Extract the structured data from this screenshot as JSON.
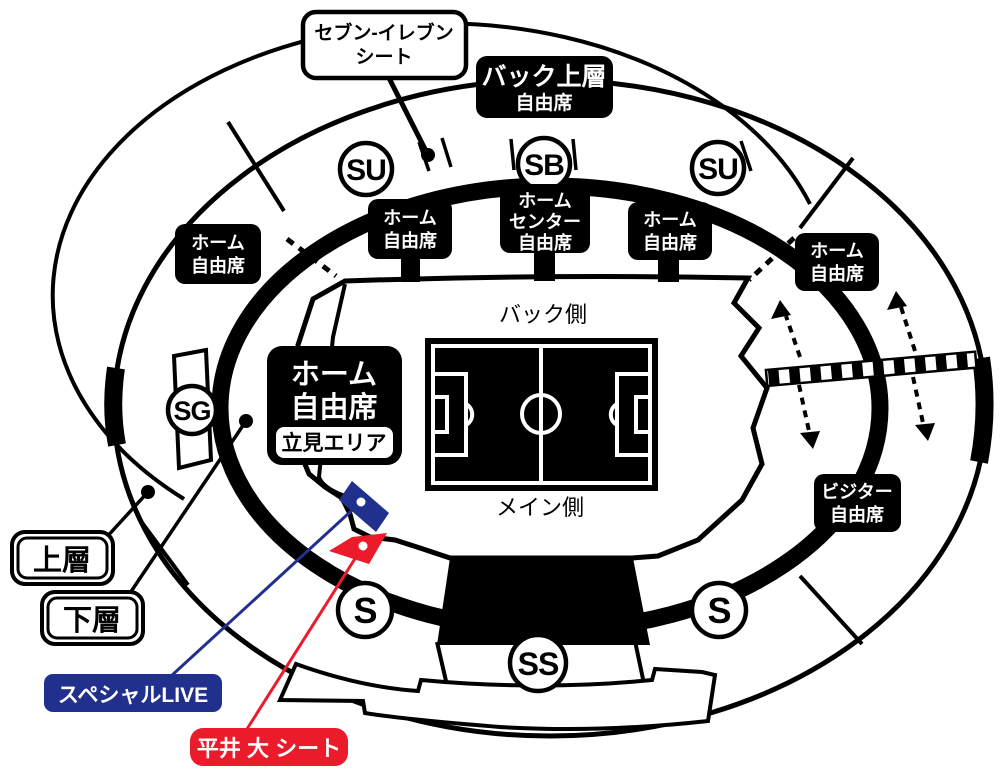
{
  "colors": {
    "special_live_navy": "#22308d",
    "hirai_red": "#ec1b2c",
    "map_black": "#000000"
  },
  "field": {
    "back_side": "バック側",
    "main_side": "メイン側"
  },
  "gates": [
    {
      "label": "SU"
    },
    {
      "label": "SB"
    },
    {
      "label": "SU"
    },
    {
      "label": "SG"
    },
    {
      "label": "S"
    },
    {
      "label": "SS"
    },
    {
      "label": "S"
    }
  ],
  "seat_labels": {
    "seven_eleven": {
      "line1": "セブン-イレブン",
      "line2": "シート"
    },
    "back_upper": {
      "line1": "バック上層",
      "line2": "自由席"
    },
    "home_top_left": {
      "line1": "ホーム",
      "line2": "自由席"
    },
    "home_center": {
      "line1": "ホーム",
      "line2": "センター",
      "line3": "自由席"
    },
    "home_top_right": {
      "line1": "ホーム",
      "line2": "自由席"
    },
    "home_left": {
      "line1": "ホーム",
      "line2": "自由席"
    },
    "home_right": {
      "line1": "ホーム",
      "line2": "自由席"
    },
    "home_standing": {
      "line1": "ホーム",
      "line2": "自由席",
      "area": "立見エリア"
    },
    "visitor": {
      "line1": "ビジター",
      "line2": "自由席"
    }
  },
  "tier_labels": {
    "upper": "上層",
    "lower": "下層"
  },
  "special_labels": {
    "special_live": "スペシャルLIVE",
    "hirai_dai_seat": "平井 大 シート"
  }
}
